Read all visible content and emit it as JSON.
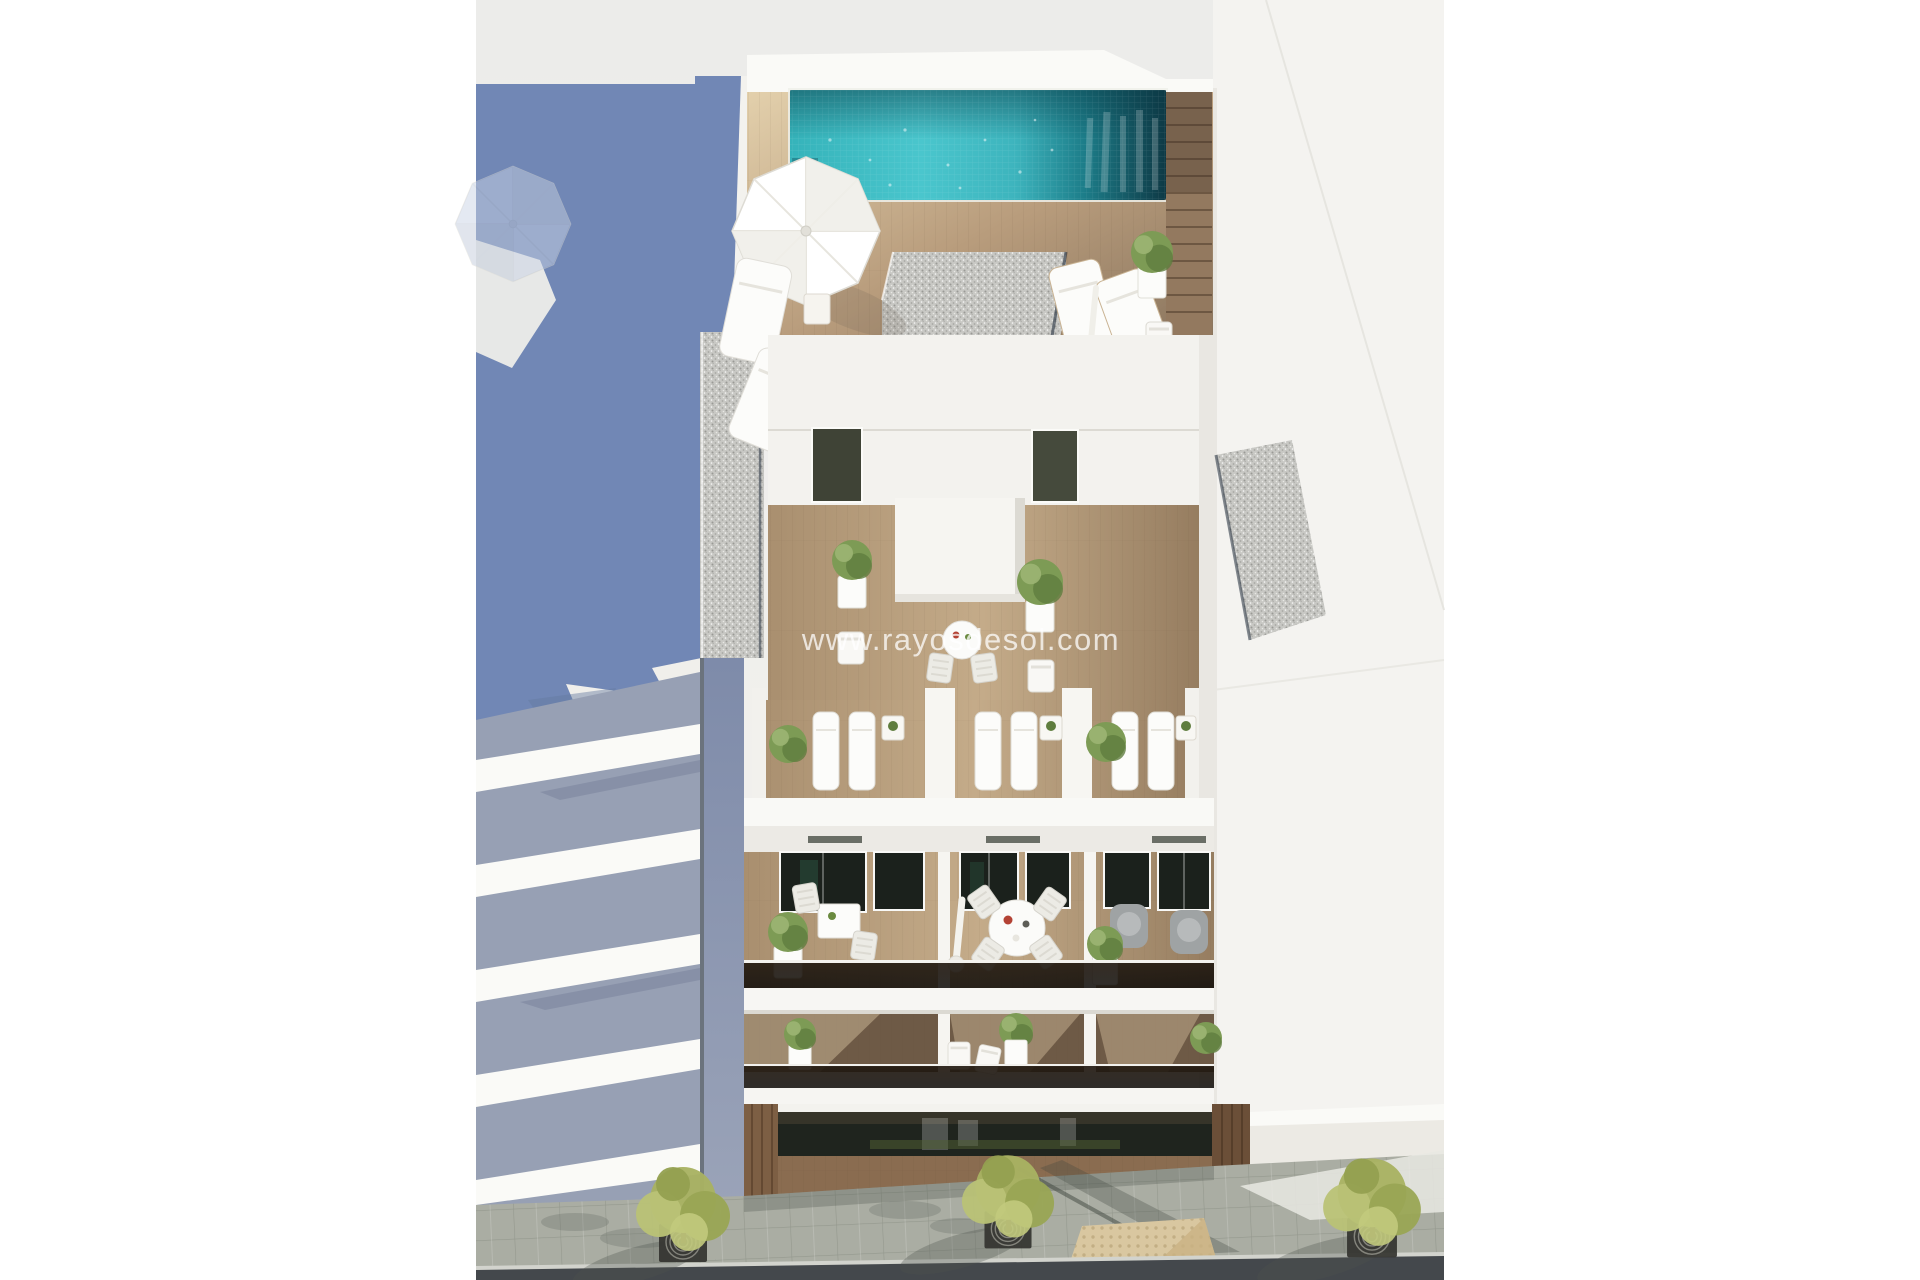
{
  "watermark": {
    "text": "www.rayosdesol.com"
  },
  "colors": {
    "page_bg": "#ffffff",
    "content_top": "#ececea",
    "content_mid": "#f1f0ec",
    "shadow_blue": "#7187b5",
    "gap_wall": "#8893ad",
    "slab_shadow": "#97a0b4",
    "wall_white": "#f4f3f0",
    "wall_bright": "#fafaf7",
    "wall_shade": "#e2e1dc",
    "deck_pale": "#e3d0ac",
    "wood_mid": "#9d8568",
    "wood_dark": "#7b6651",
    "wood_door": "#7d5f44",
    "pool_bright": "#4ac6cd",
    "pool_mid": "#2da5ae",
    "pool_dark": "#166471",
    "pool_deepest": "#0e3945",
    "gravel_base": "#c8c8c4",
    "glass_dark": "#1b211c",
    "plant_green": "#7d9b55",
    "plant_dark": "#5f7d3e",
    "tree_green": "#a9b262",
    "tree_light": "#c2ca7d",
    "pavement": "#aaada3",
    "tactile": "#d9c7a0",
    "curb": "#d2d3cd",
    "road": "#44484c",
    "white_furniture": "#fcfcfa",
    "gray_chair": "#9fa3a4",
    "grate_metal": "#33332f"
  }
}
